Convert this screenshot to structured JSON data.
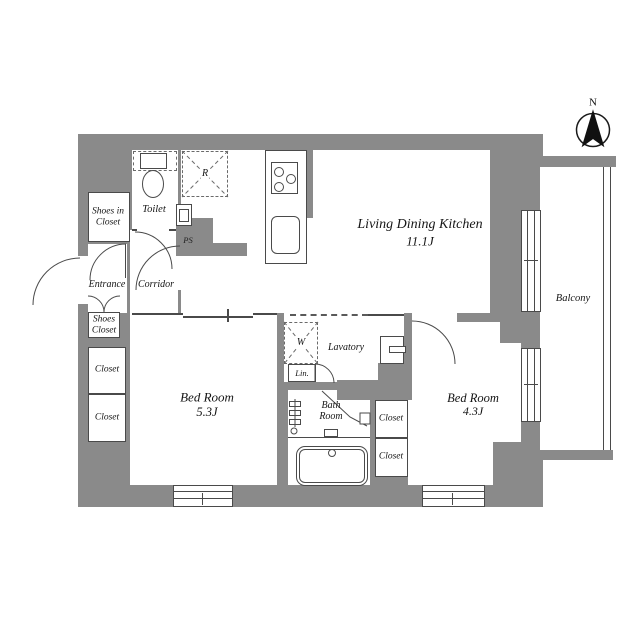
{
  "plan": {
    "type": "apartment_floor_plan",
    "compass": "N",
    "rooms": {
      "ldk": {
        "name": "Living Dining Kitchen",
        "size": "11.1J"
      },
      "bedroom1": {
        "name": "Bed Room",
        "size": "5.3J"
      },
      "bedroom2": {
        "name": "Bed Room",
        "size": "4.3J"
      },
      "balcony": "Balcony",
      "toilet": "Toilet",
      "entrance": "Entrance",
      "corridor": "Corridor",
      "shoes_in_closet_line1": "Shoes in",
      "shoes_in_closet_line2": "Closet",
      "shoes_closet_line1": "Shoes",
      "shoes_closet_line2": "Closet",
      "closet": "Closet",
      "lavatory": "Lavatory",
      "linen": "Lin.",
      "bath_line1": "Bath",
      "bath_line2": "Room",
      "ps": "PS",
      "refrigerator": "R",
      "washer": "W"
    },
    "colors": {
      "wall": "#8a8a8a",
      "line": "#4a4a4a",
      "text": "#151515"
    }
  }
}
